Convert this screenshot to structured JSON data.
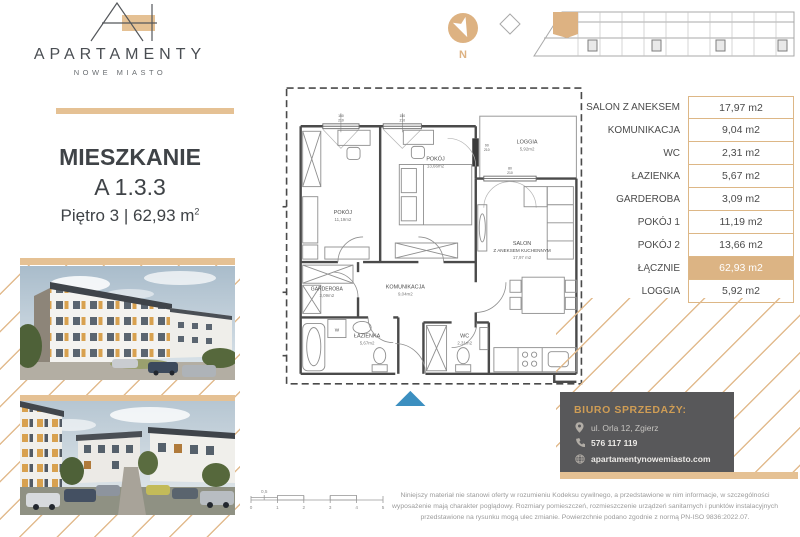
{
  "brand": {
    "name": "APARTAMENTY",
    "subtitle": "NOWE MIASTO"
  },
  "apartment": {
    "heading": "MIESZKANIE",
    "unit": "A 1.3.3",
    "floor_line": "Piętro 3 | 62,93 m",
    "floor_sup": "2"
  },
  "compass": {
    "label": "N"
  },
  "area_table": {
    "rows": [
      {
        "label": "SALON Z ANEKSEM",
        "value": "17,97 m2",
        "highlight": false
      },
      {
        "label": "KOMUNIKACJA",
        "value": "9,04 m2",
        "highlight": false
      },
      {
        "label": "WC",
        "value": "2,31 m2",
        "highlight": false
      },
      {
        "label": "ŁAZIENKA",
        "value": "5,67 m2",
        "highlight": false
      },
      {
        "label": "GARDEROBA",
        "value": "3,09 m2",
        "highlight": false
      },
      {
        "label": "POKÓJ 1",
        "value": "11,19 m2",
        "highlight": false
      },
      {
        "label": "POKÓJ 2",
        "value": "13,66 m2",
        "highlight": false
      },
      {
        "label": "ŁĄCZNIE",
        "value": "62,93 m2",
        "highlight": true
      },
      {
        "label": "LOGGIA",
        "value": "5,92 m2",
        "highlight": false
      }
    ]
  },
  "floorplan": {
    "rooms": {
      "pokoj1": {
        "name": "POKÓJ",
        "area": "11,19m2"
      },
      "pokoj2": {
        "name": "POKÓJ",
        "area": "13,66m2"
      },
      "loggia": {
        "name": "LOGGIA",
        "area": "5,92m2"
      },
      "salon": {
        "name": "SALON",
        "name2": "Z ANEKSEM KUCHENNYM",
        "area": "17,97 m2"
      },
      "garderoba": {
        "name": "GARDEROBA",
        "area": "3,09m2"
      },
      "komunikacja": {
        "name": "KOMUNIKACJA",
        "area": "9,04m2"
      },
      "lazienka": {
        "name": "ŁAZIENKA",
        "area": "5,67m2"
      },
      "wc": {
        "name": "WC",
        "area": "2,31m2"
      }
    },
    "washer_label": "W",
    "dim_markers": {
      "window1_w": "150",
      "window1_h": "210",
      "window2_w": "150",
      "window2_h": "210",
      "balcony_door_w": "90",
      "balcony_door_h": "210",
      "salon_window_w": "80",
      "salon_window_h": "210"
    }
  },
  "scalebar": {
    "ticks": [
      "0",
      "1",
      "2",
      "3",
      "4",
      "5"
    ],
    "half_label": "0,5"
  },
  "sales_office": {
    "title": "BIURO SPRZEDAŻY:",
    "address": "ul. Orla 12, Zgierz",
    "phone": "576 117 119",
    "website": "apartamentynowemiasto.com"
  },
  "disclaimer": "Niniejszy materiał nie stanowi oferty w rozumieniu Kodeksu cywilnego, a przedstawione w nim informacje, w szczególności wyposażenie mają charakter poglądowy. Rozmiary pomieszczeń, rozmieszczenie urządzeń sanitarnych i punktów instalacyjnych przedstawione na rysunku mogą ulec zmianie. Powierzchnie podano zgodnie z normą PN-ISO 9836:2022.07.",
  "colors": {
    "accent_tan": "#DDB786",
    "accent_tan_bar": "#E5C194",
    "dark_box": "#58585A",
    "gold_text": "#CF9D55",
    "plan_line": "#4A4A4A",
    "entrance_blue": "#3C8FC0"
  }
}
